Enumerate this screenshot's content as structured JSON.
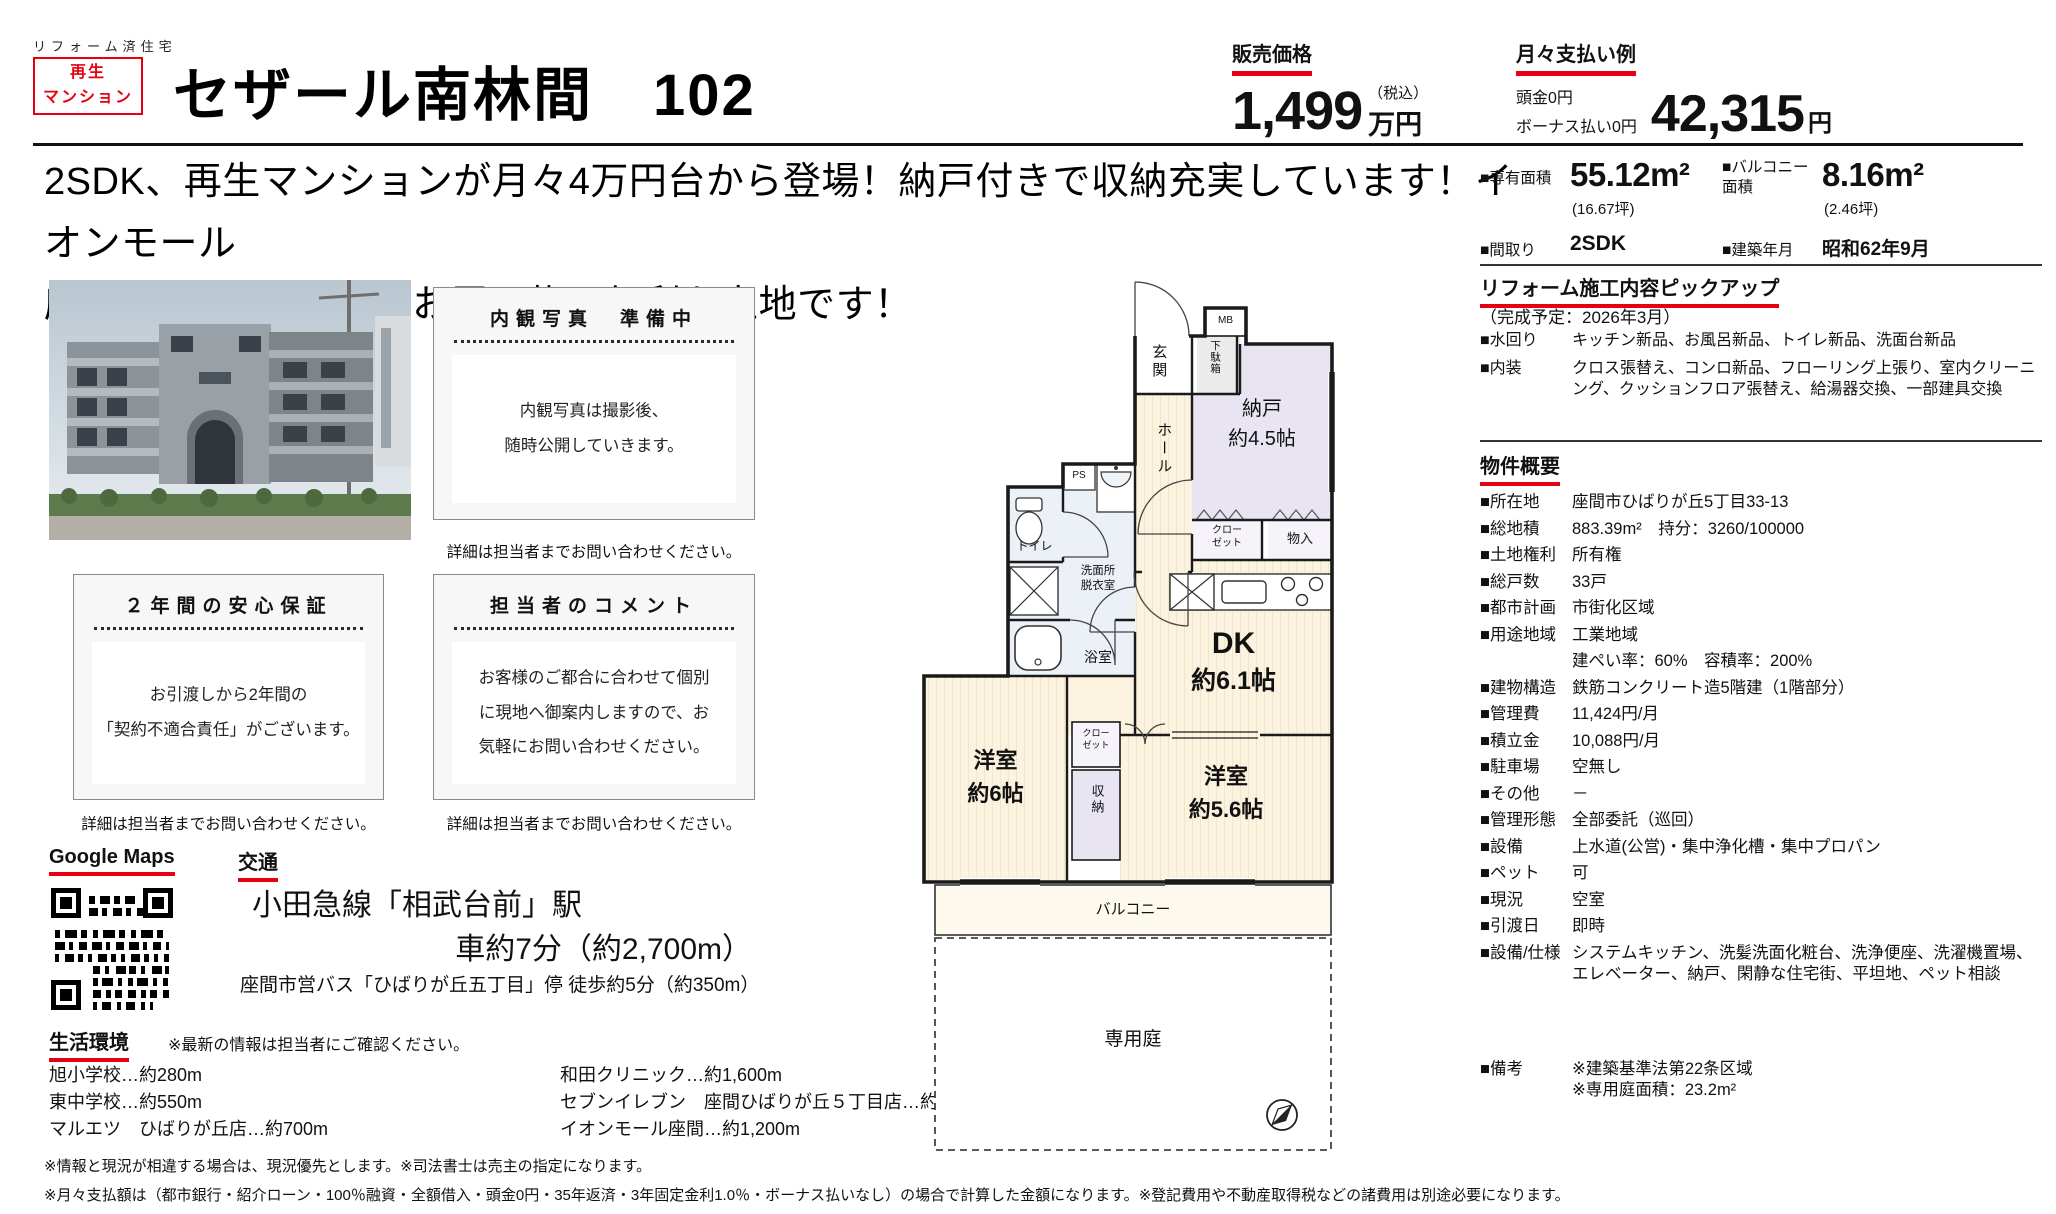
{
  "colors": {
    "accent_red": "#e60012",
    "wall": "#1a1a1a",
    "room_wood": "#fbf2df",
    "room_tatami": "#e8e4f2",
    "room_wet": "#ebf1f7"
  },
  "header": {
    "tagline": "リフォーム済住宅",
    "badge_line1": "再生",
    "badge_line2": "マンション",
    "title": "セザール南林間　102",
    "price_label": "販売価格",
    "price_value": "1,499",
    "price_tax": "（税込）",
    "price_unit": "万円",
    "monthly_label": "月々支払い例",
    "monthly_down": "頭金0円",
    "monthly_bonus": "ボーナス払い0円",
    "monthly_value": "42,315",
    "monthly_unit": "円"
  },
  "catch_copy": "2SDK、再生マンションが月々4万円台から登場！納戸付きで収納充実しています！イオンモール\n座間まで車で約3分とお買い物に便利な立地です！",
  "specs": {
    "area_label": "■専有面積",
    "area_value": "55.12m²",
    "area_tsubo": "(16.67坪)",
    "balcony_label": "■バルコニー面積",
    "balcony_value": "8.16m²",
    "balcony_tsubo": "(2.46坪)",
    "madori_label": "■間取り",
    "madori_value": "2SDK",
    "built_label": "■建築年月",
    "built_value": "昭和62年9月"
  },
  "renovation": {
    "title": "リフォーム施工内容ピックアップ",
    "schedule": "（完成予定：2026年3月）",
    "rows": [
      {
        "label": "■水回り",
        "value": "キッチン新品、お風呂新品、トイレ新品、洗面台新品"
      },
      {
        "label": "■内装",
        "value": "クロス張替え、コンロ新品、フローリング上張り、室内クリーニング、クッションフロア張替え、給湯器交換、一部建具交換"
      }
    ]
  },
  "overview": {
    "title": "物件概要",
    "rows": [
      {
        "label": "■所在地",
        "value": "座間市ひばりが丘5丁目33-13"
      },
      {
        "label": "■総地積",
        "value": "883.39m²　持分：3260/100000"
      },
      {
        "label": "■土地権利",
        "value": "所有権"
      },
      {
        "label": "■総戸数",
        "value": "33戸"
      },
      {
        "label": "■都市計画",
        "value": "市街化区域"
      },
      {
        "label": "■用途地域",
        "value": "工業地域"
      },
      {
        "label": "",
        "value": "建ぺい率：60%　容積率：200%"
      },
      {
        "label": "■建物構造",
        "value": "鉄筋コンクリート造5階建（1階部分）"
      },
      {
        "label": "■管理費",
        "value": "11,424円/月"
      },
      {
        "label": "■積立金",
        "value": "10,088円/月"
      },
      {
        "label": "■駐車場",
        "value": "空無し"
      },
      {
        "label": "■その他",
        "value": "－"
      },
      {
        "label": "■管理形態",
        "value": "全部委託（巡回）"
      },
      {
        "label": "■設備",
        "value": "上水道(公営)・集中浄化槽・集中プロパン"
      },
      {
        "label": "■ペット",
        "value": "可"
      },
      {
        "label": "■現況",
        "value": "空室"
      },
      {
        "label": "■引渡日",
        "value": "即時"
      },
      {
        "label": "■設備/仕様",
        "value": "システムキッチン、洗髪洗面化粧台、洗浄便座、洗濯機置場、エレベーター、納戸、閑静な住宅街、平坦地、ペット相談"
      },
      {
        "label": "■備考",
        "value": "※建築基準法第22条区域\n※専用庭面積：23.2m²"
      }
    ]
  },
  "naikan_box": {
    "title": "内観写真　準備中",
    "body": "内観写真は撮影後、\n随時公開していきます。",
    "caption": "詳細は担当者までお問い合わせください。"
  },
  "hosho_box": {
    "title": "２年間の安心保証",
    "body": "お引渡しから2年間の\n「契約不適合責任」がございます。",
    "caption": "詳細は担当者までお問い合わせください。"
  },
  "comment_box": {
    "title": "担当者のコメント",
    "body": "お客様のご都合に合わせて個別\nに現地へ御案内しますので、お\n気軽にお問い合わせください。",
    "caption": "詳細は担当者までお問い合わせください。"
  },
  "map": {
    "label": "Google Maps"
  },
  "access": {
    "label": "交通",
    "line1": "小田急線「相武台前」駅",
    "line2": "車約7分（約2,700m）",
    "line3": "座間市営バス「ひばりが丘五丁目」停 徒歩約5分（約350m）"
  },
  "life": {
    "label": "生活環境",
    "note": "※最新の情報は担当者にご確認ください。",
    "col1": [
      "旭小学校…約280m",
      "東中学校…約550m",
      "マルエツ　ひばりが丘店…約700m"
    ],
    "col2": [
      "和田クリニック…約1,600m",
      "セブンイレブン　座間ひばりが丘５丁目店…約57m",
      "イオンモール座間…約1,200m"
    ]
  },
  "disclaimers": [
    "※情報と現況が相違する場合は、現況優先とします。※司法書士は売主の指定になります。",
    "※月々支払額は（都市銀行・紹介ローン・100％融資・全額借入・頭金0円・35年返済・3年固定金利1.0％・ボーナス払いなし）の場合で計算した金額になります。※登記費用や不動産取得税などの諸費用は別途必要になります。"
  ],
  "floorplan": {
    "genkan": "玄関",
    "getabako": "下駄箱",
    "mb": "MB",
    "nando_name": "納戸",
    "nando_size": "約4.5帖",
    "hall": "ホール",
    "closet_top_1": "クロー",
    "closet_top_2": "ゼット",
    "monoire": "物入",
    "toilet": "トイレ",
    "ps": "PS",
    "senmen_1": "洗面所",
    "senmen_2": "脱衣室",
    "bath": "浴室",
    "dk_name": "DK",
    "dk_size": "約6.1帖",
    "west6_name": "洋室",
    "west6_size": "約6帖",
    "closet_mid_1": "クロー",
    "closet_mid_2": "ゼット",
    "shuno": "収納",
    "west56_name": "洋室",
    "west56_size": "約5.6帖",
    "balcony": "バルコニー",
    "garden": "専用庭"
  }
}
